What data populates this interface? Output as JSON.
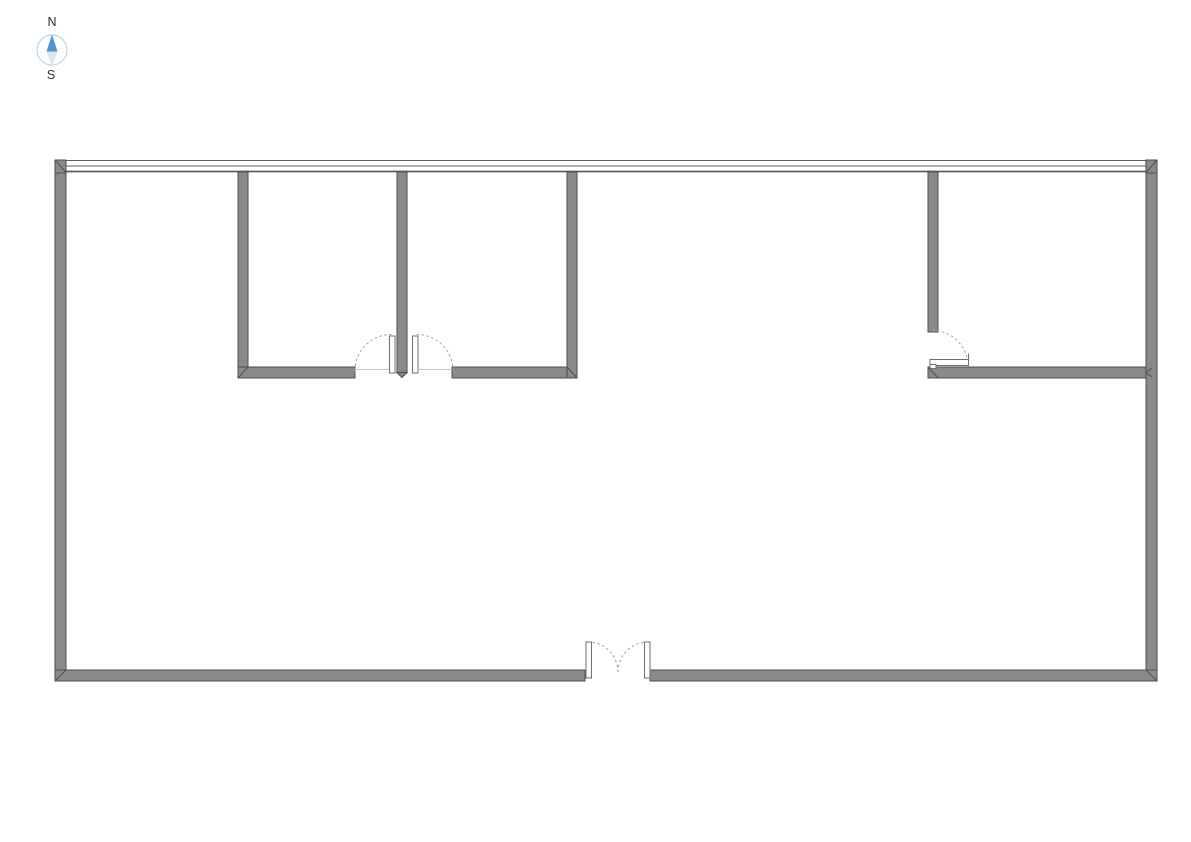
{
  "page": {
    "width": 1191,
    "height": 842,
    "background": "#ffffff"
  },
  "compass": {
    "north_label": "N",
    "south_label": "S",
    "cx": 52,
    "cy": 50,
    "r": 15,
    "circle_color": "#b7d7e8",
    "north_color": "#4e96d3",
    "south_color": "#dde6ee",
    "north_points": "52,34.5 46.5,51.5 57.5,51.5",
    "south_points": "46.5,51.5 57.5,51.5 52,66.5",
    "label_color": "#2d2d2d"
  },
  "floorplan": {
    "colors": {
      "wall_fill": "#8a8a8a",
      "wall_stroke": "#4e4e4e",
      "window_line": "#5e5e5e",
      "swing_arc": "#a9a9a9",
      "leaf_fill": "#ffffff",
      "leaf_stroke": "#6e6e6e",
      "threshold": "#c2c2c2"
    },
    "window_band": {
      "x1": 55,
      "x2": 1157,
      "lines": [
        {
          "y": 160.5,
          "w": 1.1
        },
        {
          "y": 166.0,
          "w": 1.1
        },
        {
          "y": 171.5,
          "w": 1.7
        }
      ]
    },
    "walls": [
      {
        "name": "wall-outer-left",
        "x": 55,
        "y": 172,
        "w": 11,
        "h": 509
      },
      {
        "name": "wall-outer-right",
        "x": 1146,
        "y": 172,
        "w": 11,
        "h": 509
      },
      {
        "name": "wall-bottom-west-segment",
        "x": 55,
        "y": 670,
        "w": 530,
        "h": 11
      },
      {
        "name": "wall-bottom-east-segment",
        "x": 650,
        "y": 670,
        "w": 507,
        "h": 11
      },
      {
        "name": "window-corner-cap-left",
        "x": 55,
        "y": 160,
        "w": 11,
        "h": 13
      },
      {
        "name": "window-corner-cap-right",
        "x": 1146,
        "y": 160,
        "w": 11,
        "h": 13
      },
      {
        "name": "wall-room1-west",
        "x": 238,
        "y": 172,
        "w": 10,
        "h": 195
      },
      {
        "name": "wall-room1-bottom",
        "x": 238,
        "y": 367,
        "w": 117,
        "h": 11
      },
      {
        "name": "wall-divider-room1-room2",
        "x": 397,
        "y": 172,
        "w": 10,
        "h": 201
      },
      {
        "name": "wall-room2-bottom",
        "x": 452,
        "y": 367,
        "w": 125,
        "h": 11
      },
      {
        "name": "wall-room2-east",
        "x": 567,
        "y": 172,
        "w": 10,
        "h": 206
      },
      {
        "name": "wall-room3-west",
        "x": 928,
        "y": 172,
        "w": 10,
        "h": 160
      },
      {
        "name": "wall-room3-bottom",
        "x": 928,
        "y": 367,
        "w": 218,
        "h": 11
      }
    ],
    "polygons": [
      {
        "name": "wall-divider-tip",
        "points": "397,372.5 407,372.5 402,377.5"
      }
    ],
    "miters": [
      {
        "name": "miter-top-left",
        "x1": 55,
        "y1": 160,
        "x2": 66,
        "y2": 172.5
      },
      {
        "name": "miter-top-right",
        "x1": 1157,
        "y1": 160,
        "x2": 1146,
        "y2": 172.5
      },
      {
        "name": "miter-bottom-left",
        "x1": 55,
        "y1": 681,
        "x2": 66,
        "y2": 670
      },
      {
        "name": "miter-bottom-right",
        "x1": 1157,
        "y1": 681,
        "x2": 1146,
        "y2": 670
      },
      {
        "name": "miter-room1-corner",
        "x1": 238,
        "y1": 378,
        "x2": 248,
        "y2": 367
      },
      {
        "name": "miter-room2-corner",
        "x1": 567,
        "y1": 367,
        "x2": 577,
        "y2": 378
      },
      {
        "name": "miter-room3-corner",
        "x1": 928,
        "y1": 367.5,
        "x2": 938,
        "y2": 377.5
      },
      {
        "name": "miter-room3-tjoint-a",
        "x1": 1152,
        "y1": 368,
        "x2": 1146,
        "y2": 372.5
      },
      {
        "name": "miter-room3-tjoint-b",
        "x1": 1146,
        "y1": 372.5,
        "x2": 1152,
        "y2": 377
      }
    ],
    "doors": [
      {
        "name": "door-room1",
        "thresholds": [
          {
            "x1": 355,
            "y1": 369.5,
            "x2": 389,
            "y2": 369.5
          }
        ],
        "arcs": [
          "M 355 370.5 A 36 36 0 0 1 391 334.5"
        ],
        "leaves": [
          {
            "x": 389.5,
            "y": 336,
            "w": 5.5,
            "h": 37
          }
        ],
        "lines": []
      },
      {
        "name": "door-room2",
        "thresholds": [
          {
            "x1": 419,
            "y1": 369.5,
            "x2": 452,
            "y2": 369.5
          }
        ],
        "arcs": [
          "M 417 334.5 A 36 36 0 0 1 453 370.5"
        ],
        "leaves": [
          {
            "x": 412.5,
            "y": 336,
            "w": 5.5,
            "h": 37
          }
        ],
        "lines": []
      },
      {
        "name": "door-room3",
        "thresholds": [],
        "arcs": [
          "M 932.5 330.5 A 35.5 35.5 0 0 1 968 366"
        ],
        "leaves": [
          {
            "x": 930,
            "y": 359.5,
            "w": 38.5,
            "h": 6
          },
          {
            "x": 930,
            "y": 364.5,
            "w": 6,
            "h": 4
          }
        ],
        "lines": [
          {
            "x1": 968.5,
            "y1": 353.5,
            "x2": 968.5,
            "y2": 359.5
          }
        ]
      },
      {
        "name": "door-entrance-left",
        "thresholds": [],
        "arcs": [
          "M 588 642 A 30 30 0 0 1 618 672"
        ],
        "leaves": [
          {
            "x": 586,
            "y": 642,
            "w": 5.5,
            "h": 36
          }
        ],
        "lines": []
      },
      {
        "name": "door-entrance-right",
        "thresholds": [],
        "arcs": [
          "M 648 642 A 30 30 0 0 0 618 672"
        ],
        "leaves": [
          {
            "x": 644.5,
            "y": 642,
            "w": 5.5,
            "h": 36
          }
        ],
        "lines": []
      }
    ]
  }
}
